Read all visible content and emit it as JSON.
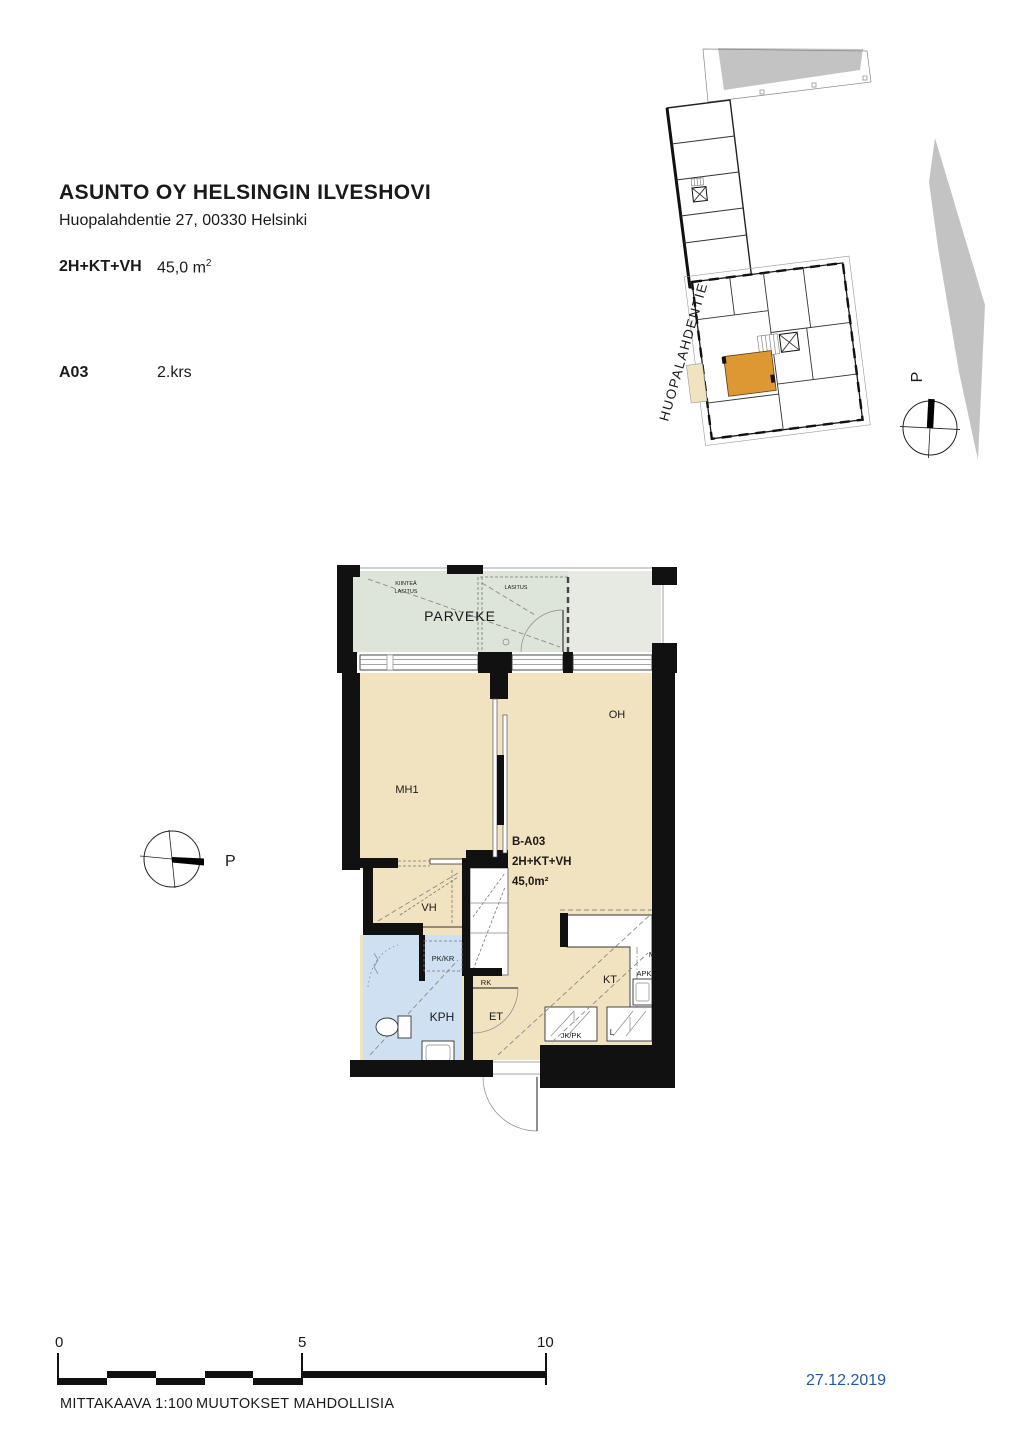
{
  "header": {
    "title": "ASUNTO OY HELSINGIN ILVESHOVI",
    "address": "Huopalahdentie 27, 00330 Helsinki",
    "apartment_type": "2H+KT+VH",
    "area_value": "45,0 m",
    "area_exp": "2",
    "unit": "A03",
    "floor": "2.krs"
  },
  "site_plan": {
    "street_label": "HUOPALAHDENTIE",
    "compass_label": "P"
  },
  "floor_plan": {
    "compass_label": "P",
    "balcony_label": "PARVEKE",
    "glazing_fixed_line1": "KIINTEÄ",
    "glazing_fixed_line2": "LASITUS",
    "glazing_label": "LASITUS",
    "rooms": {
      "mh1": "MH1",
      "oh": "OH",
      "vh": "VH",
      "kph": "KPH",
      "et": "ET",
      "kt": "KT"
    },
    "unit_info": {
      "code": "B-A03",
      "type": "2H+KT+VH",
      "area": "45,0m²"
    },
    "fixtures": {
      "pk_kr": "PK/KR",
      "rk": "RK",
      "jk_pk": "JK/PK",
      "l": "L",
      "apk": "APK",
      "m": "M"
    }
  },
  "footer": {
    "scale_0": "0",
    "scale_5": "5",
    "scale_10": "10",
    "scale_text": "MITTAKAAVA 1:100",
    "disclaimer": "MUUTOKSET MAHDOLLISIA",
    "date": "27.12.2019"
  },
  "colors": {
    "floor": "#f1e2c0",
    "balcony": "#dde4d8",
    "balcony_neighbor": "#e6eae3",
    "bathroom": "#cfe0f2",
    "highlight": "#dd9733",
    "site_gray": "#c3c3c3",
    "wall": "#111111",
    "date_blue": "#2258a8"
  }
}
